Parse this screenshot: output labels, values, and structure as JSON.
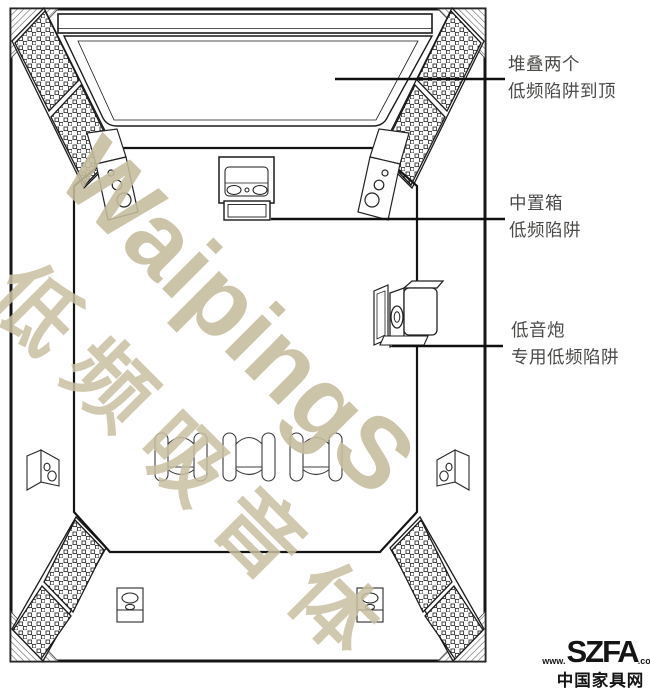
{
  "annotations": {
    "stacked": {
      "line1": "堆叠两个",
      "line2": "低频陷阱到顶"
    },
    "center": {
      "line1": "中置箱",
      "line2": "低频陷阱"
    },
    "sub": {
      "line1": "低音炮",
      "line2": "专用低频陷阱"
    }
  },
  "watermark": {
    "en": "WaipingS",
    "cn": "低频吸音体",
    "color": "#c6bd9e"
  },
  "logo": {
    "www": "www.",
    "name": "SZFA",
    "com": ".com",
    "cn": "中国家具网"
  },
  "colors": {
    "line_art": "#1a1a1a",
    "label_text": "#4a4a48",
    "watermark": "#c6bd9e",
    "logo": "#141414",
    "background": "#ffffff"
  }
}
